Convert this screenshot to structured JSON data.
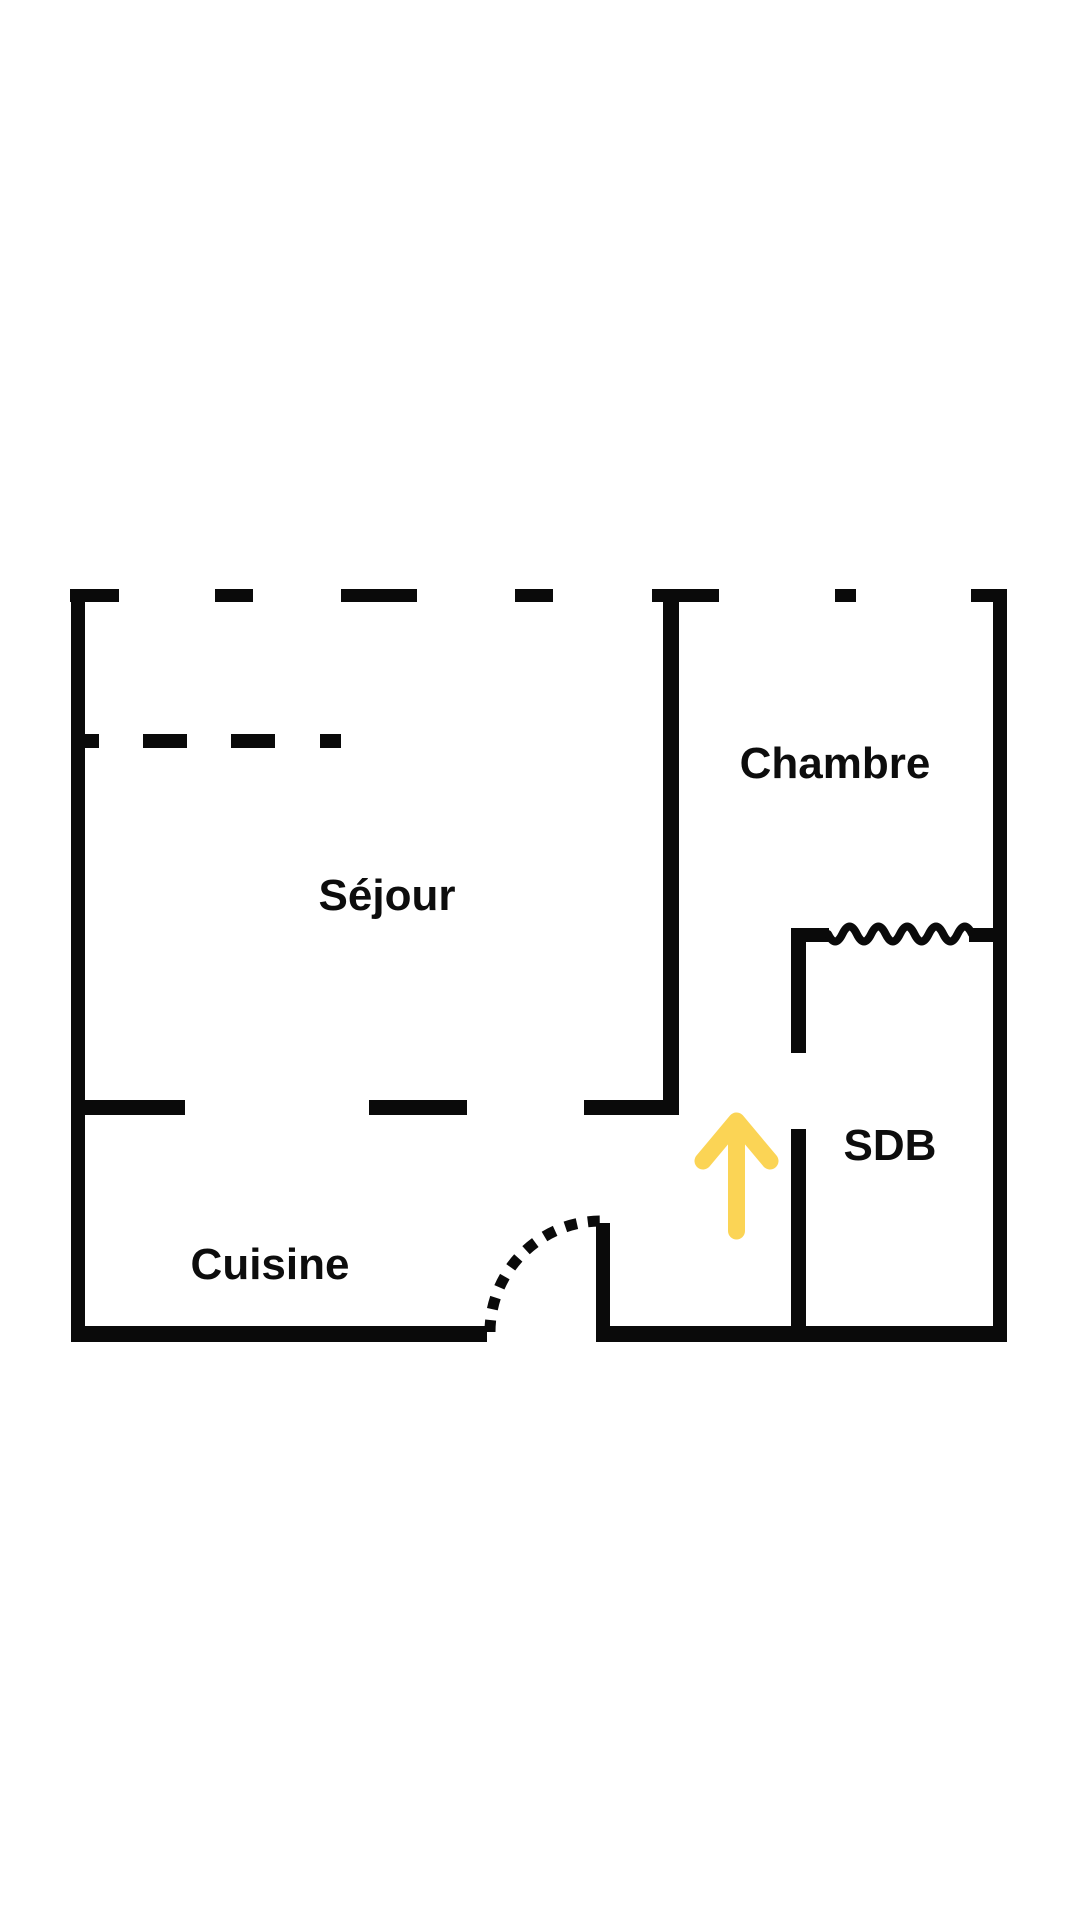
{
  "page": {
    "background_color": "#ffffff"
  },
  "floor_plan": {
    "wall_color": "#0a0a0a",
    "label_color": "#0d0d0d",
    "rooms": [
      {
        "id": "sejour",
        "label": "Séjour"
      },
      {
        "id": "chambre",
        "label": "Chambre"
      },
      {
        "id": "sdb",
        "label": "SDB"
      },
      {
        "id": "cuisine",
        "label": "Cuisine"
      }
    ],
    "markers": {
      "entrance_arrow": {
        "icon": "up-arrow-icon",
        "color": "#FBD455",
        "direction": "up"
      },
      "door_swing": {
        "icon": "door-swing-arc",
        "style": "dashed quarter circle"
      },
      "window_wave": {
        "icon": "window-wave-icon",
        "style": "squiggle"
      }
    }
  }
}
